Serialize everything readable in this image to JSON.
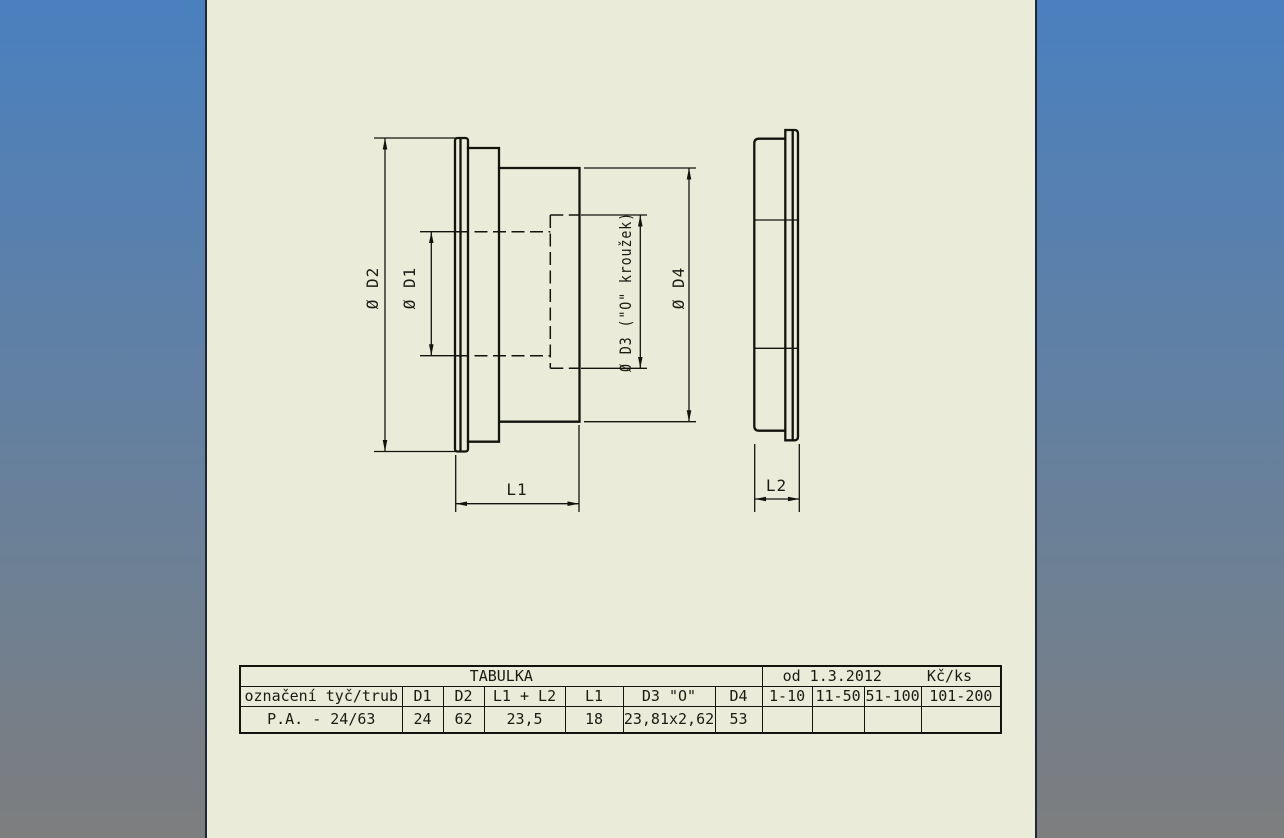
{
  "page": {
    "sheet_color": "#eaecd9",
    "backdrop_top_color": "#4a80bf",
    "backdrop_bottom_color": "#7d7e7e",
    "line_color": "#14140f"
  },
  "drawing": {
    "labels": {
      "d2": "Ø D2",
      "d1": "Ø D1",
      "d3": "Ø D3 (\"O\" kroužek)",
      "d4": "Ø D4",
      "l1": "L1",
      "l2": "L2"
    }
  },
  "table": {
    "title": "TABULKA",
    "price_header": {
      "from": "od 1.3.2012",
      "unit": "Kč/ks"
    },
    "columns": [
      "označení tyč/trub",
      "D1",
      "D2",
      "L1 + L2",
      "L1",
      "D3 \"O\"",
      "D4",
      "1-10",
      "11-50",
      "51-100",
      "101-200"
    ],
    "rows": [
      [
        "P.A. - 24/63",
        "24",
        "62",
        "23,5",
        "18",
        "23,81x2,62",
        "53",
        "",
        "",
        "",
        ""
      ]
    ]
  }
}
